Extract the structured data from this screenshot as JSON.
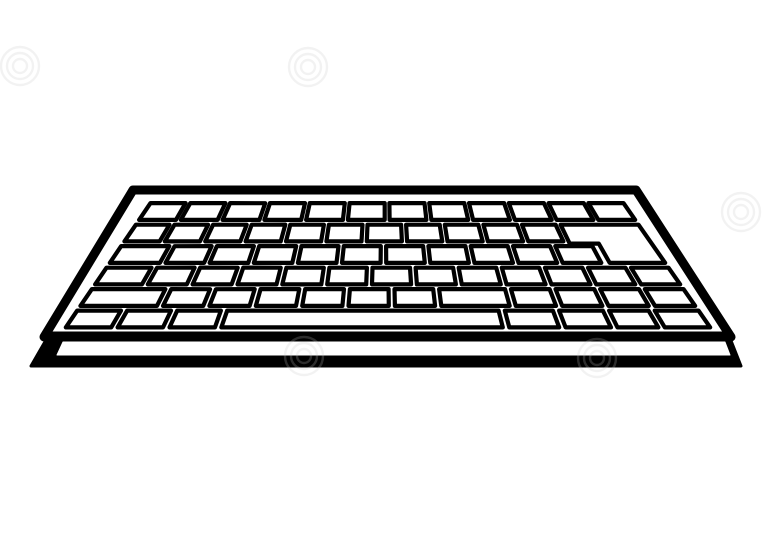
{
  "image": {
    "description": "Black and white outline clipart of a computer keyboard shown in perspective, tilted with the far edge narrower than the near edge, on a plain white background with faint stock-photo watermark swirls",
    "background_color": "#ffffff",
    "line_color": "#000000",
    "key_fill": "#ffffff",
    "watermark_color": "#c9c9c9",
    "watermark_opacity": 0.22
  },
  "keyboard": {
    "body_outline": {
      "tl": [
        133,
        190
      ],
      "tr": [
        636,
        190
      ],
      "br": [
        731,
        337
      ],
      "bl": [
        44,
        337
      ],
      "stroke_width": 9
    },
    "key_area": {
      "tl": [
        152,
        201
      ],
      "tr": [
        622,
        201
      ],
      "bl": [
        64,
        330
      ],
      "br": [
        712,
        330
      ]
    },
    "key_stroke_width": 4.2,
    "gap_u": 0.01,
    "row_count": 6,
    "rows": [
      {
        "name": "function-row",
        "weights": [
          1,
          1,
          1,
          1,
          1,
          1,
          1,
          1,
          1,
          1,
          1,
          1
        ],
        "span": 1.0
      },
      {
        "name": "number-row",
        "weights": [
          1,
          1,
          1,
          1,
          1,
          1,
          1,
          1,
          1,
          1,
          1
        ],
        "span": 0.835
      },
      {
        "name": "top-letter-row",
        "weights": [
          1.3,
          1,
          1,
          1,
          1,
          1,
          1,
          1,
          1,
          1,
          1
        ],
        "span": 0.885
      },
      {
        "name": "home-row",
        "weights": [
          1.2,
          1,
          1,
          1,
          1,
          1,
          1,
          1,
          1,
          1,
          1,
          1,
          1
        ],
        "span": 1.0
      },
      {
        "name": "shift-row",
        "weights": [
          1.9,
          1,
          1,
          1,
          1,
          1,
          1,
          1.7,
          1,
          1,
          1,
          1
        ],
        "span": 1.0
      },
      {
        "name": "bottom-row",
        "weights": [
          1,
          1,
          1,
          6.2,
          1.1,
          1,
          0.9,
          1
        ],
        "span": 1.0,
        "spacebar_index": 3
      }
    ],
    "enter_key": {
      "u_left_top": 0.845,
      "u_left_bottom": 0.9,
      "v_top_row": 1,
      "v_bottom_row": 2
    },
    "front_edge": {
      "outer": [
        [
          50,
          333
        ],
        [
          728,
          333
        ],
        [
          741,
          366
        ],
        [
          31,
          366
        ]
      ],
      "inner_band": [
        [
          63,
          342
        ],
        [
          725,
          342
        ],
        [
          730,
          355
        ],
        [
          57,
          355
        ]
      ]
    }
  },
  "watermarks": [
    {
      "name": "swirl-logo",
      "x": 20,
      "y": 66,
      "radii": [
        7,
        13,
        19
      ]
    },
    {
      "name": "swirl-logo",
      "x": 308,
      "y": 67,
      "radii": [
        7,
        13,
        19
      ]
    },
    {
      "name": "swirl-logo",
      "x": 741,
      "y": 212,
      "radii": [
        7,
        13,
        19
      ]
    },
    {
      "name": "swirl-logo",
      "x": 304,
      "y": 356,
      "radii": [
        7,
        13,
        19
      ]
    },
    {
      "name": "swirl-logo",
      "x": 597,
      "y": 358,
      "radii": [
        7,
        13,
        19
      ]
    }
  ]
}
